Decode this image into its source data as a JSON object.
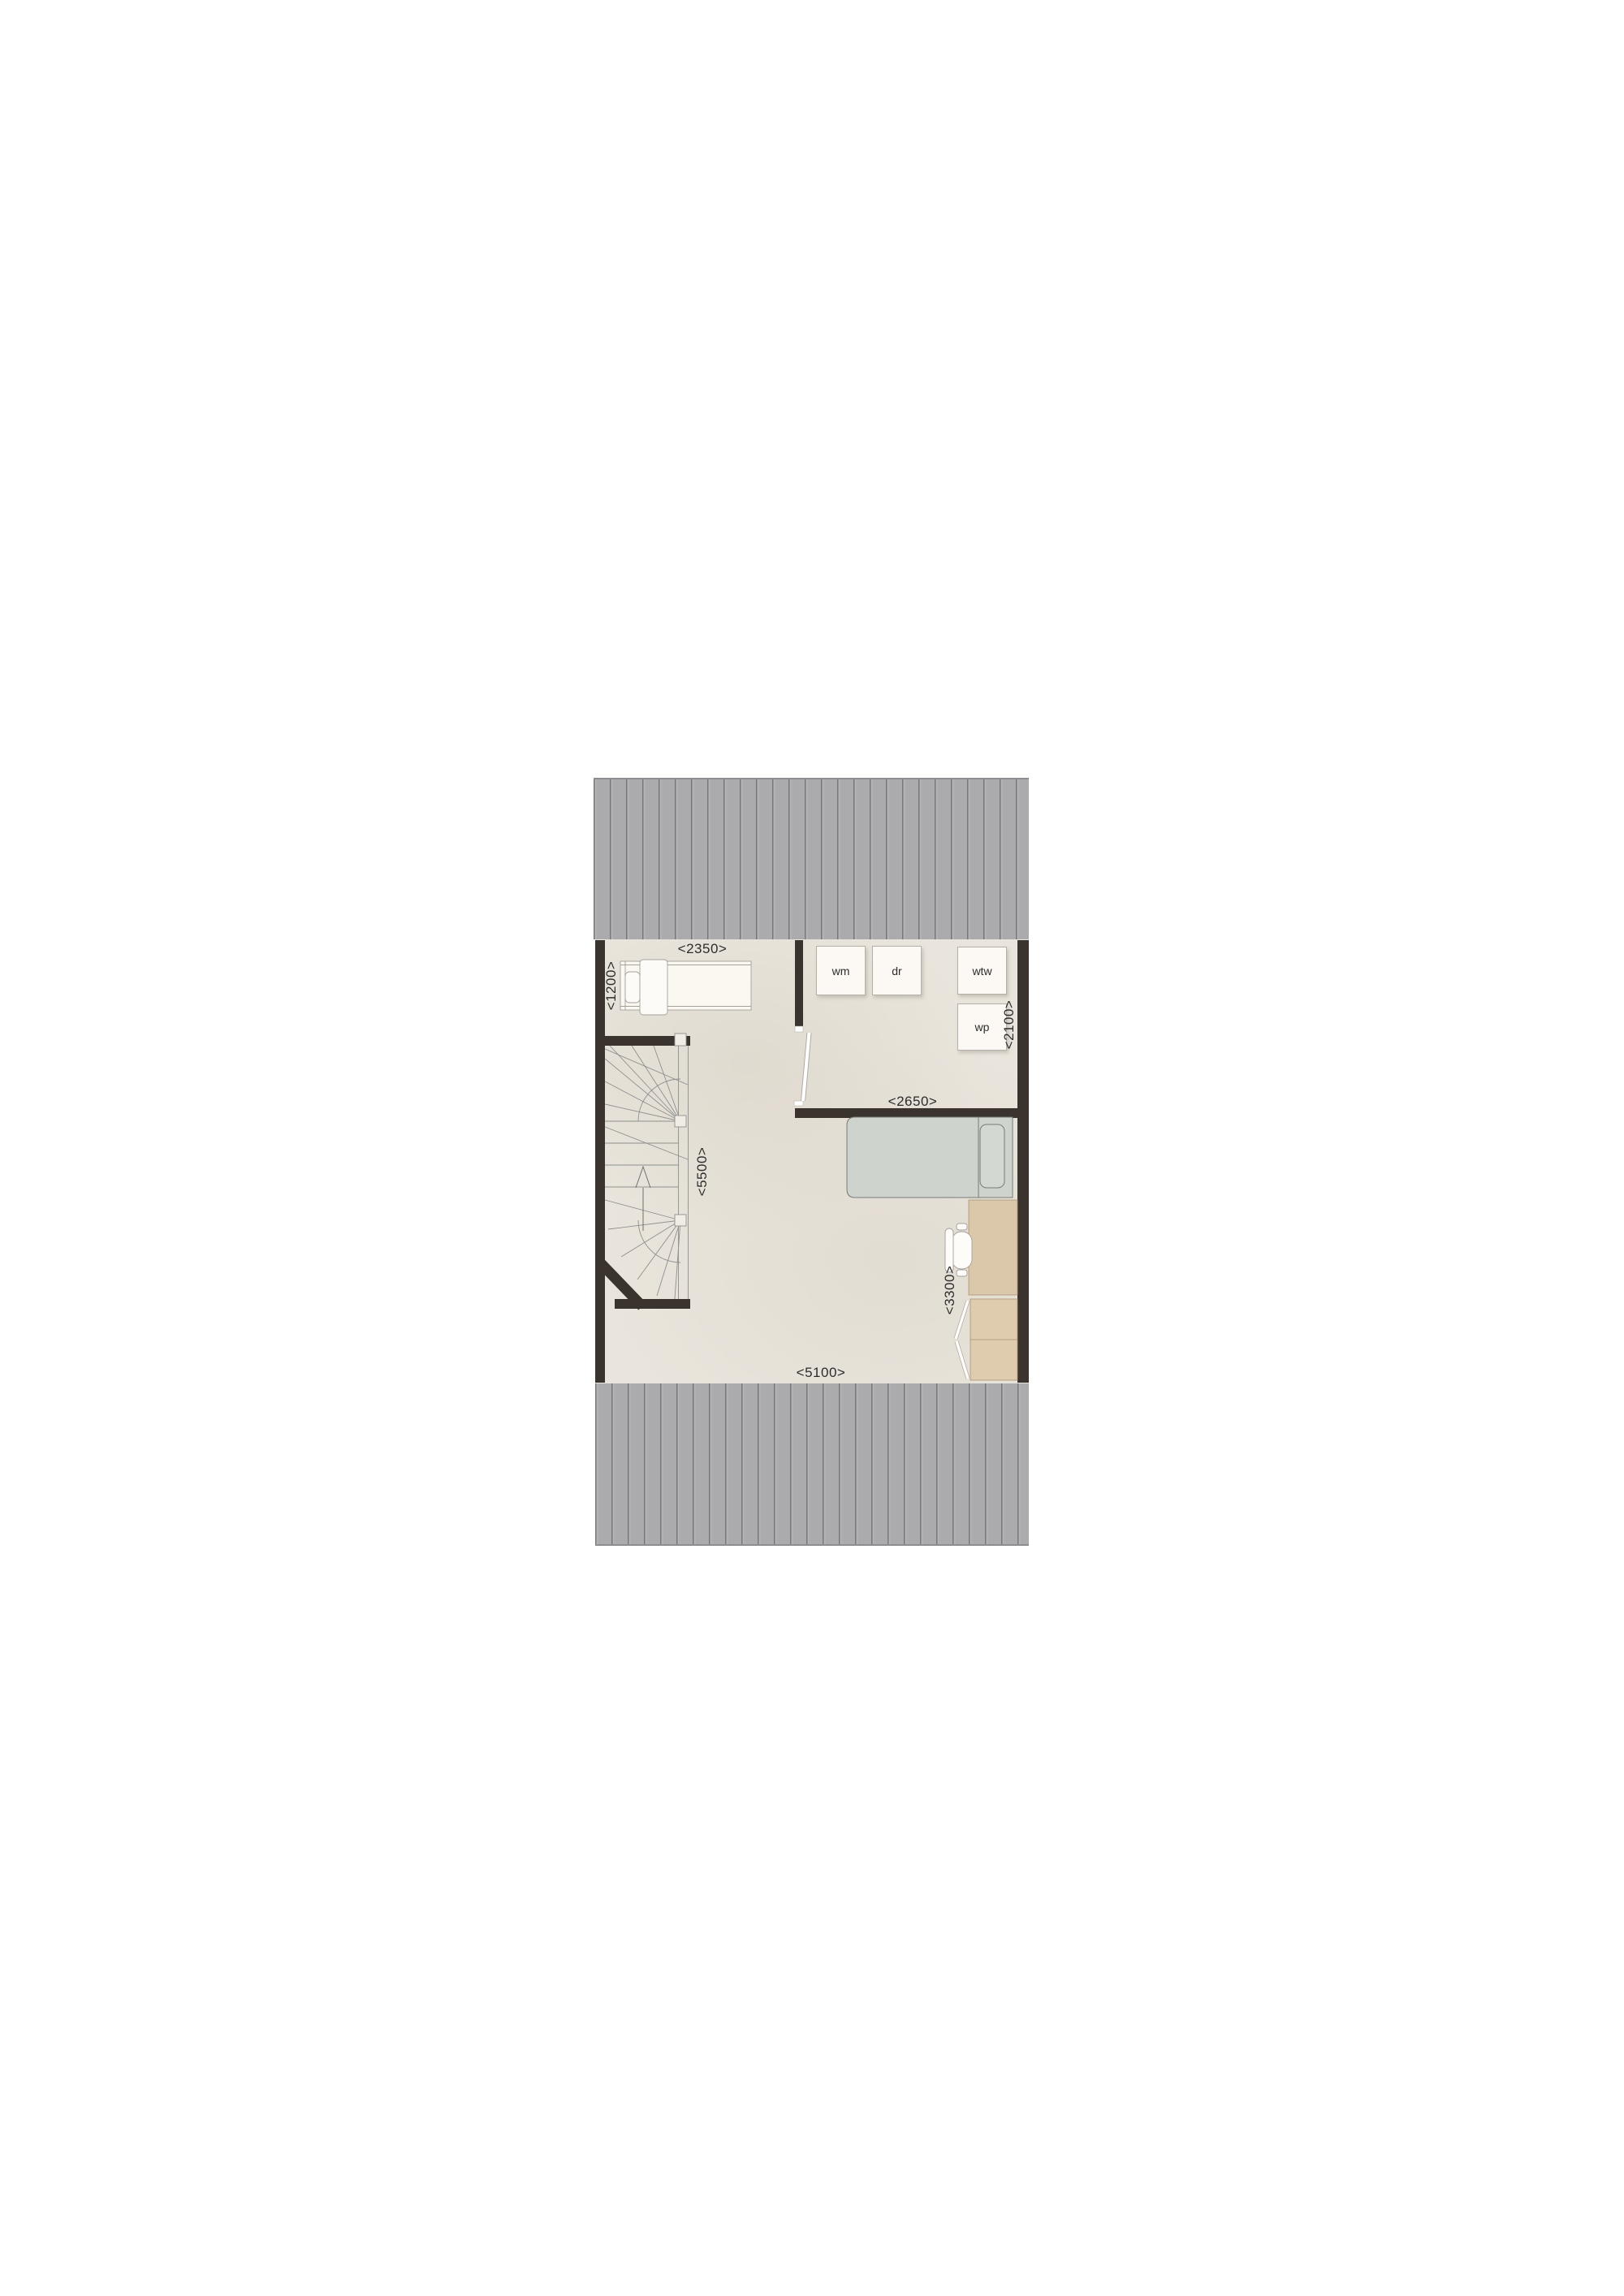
{
  "palette": {
    "roof_gray": "#ababad",
    "roof_line": "#77777b",
    "floor_beige": "#e9e5dc",
    "wall_dark": "#3b342e",
    "wood": "#dbc8aa",
    "bed_green": "#ced4cd",
    "furn_white": "#fbf8f2",
    "label_text": "#2c2c2c"
  },
  "floorplan": {
    "dimension_labels": {
      "top_room_width": "<2350>",
      "top_room_depth": "<1200>",
      "utility_depth": "<2100>",
      "bedroom_wall_width": "<2650>",
      "left_side_depth": "<5500>",
      "desk_wall_depth": "<3300>",
      "bottom_width": "<5100>"
    },
    "appliance_labels": {
      "washing_machine": "wm",
      "dryer": "dr",
      "heat_recovery_unit": "wtw",
      "heat_pump": "wp"
    }
  }
}
